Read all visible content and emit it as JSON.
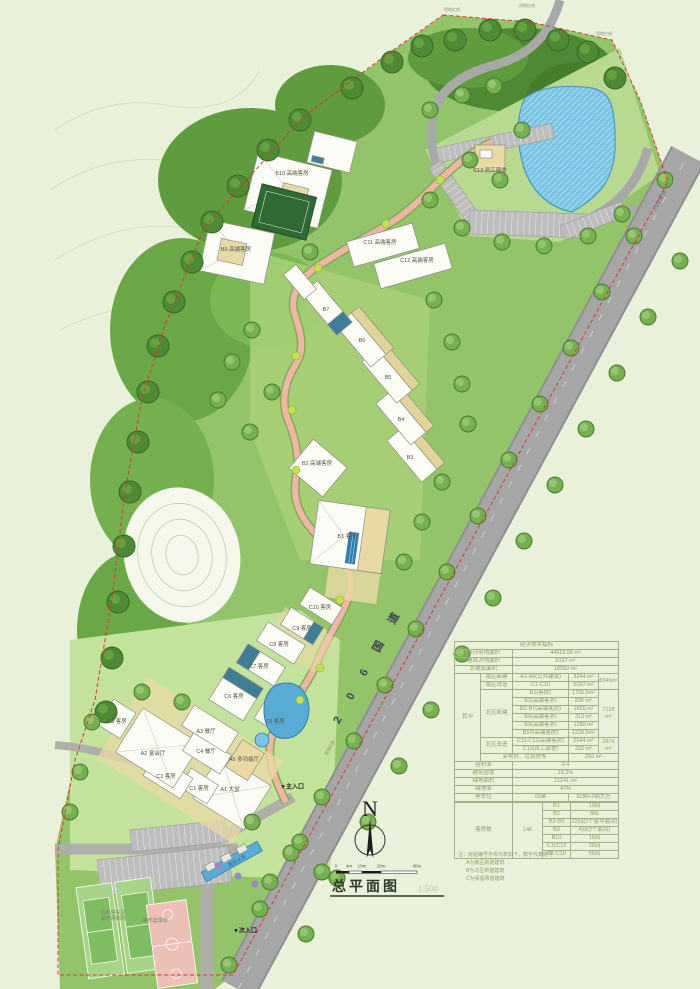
{
  "title_block": {
    "title": "总平面图",
    "scale": "1:500"
  },
  "north": {
    "label": "N"
  },
  "scalebar": {
    "ticks": [
      "0",
      "4m",
      "10m",
      "20m",
      "40m"
    ]
  },
  "road": {
    "name_spaced": "2 0 6 国 道",
    "name_small": "206国道"
  },
  "boundary": {
    "label": "用地红线"
  },
  "entrances": {
    "main": "▼主入口",
    "secondary": "▼次入口"
  },
  "water": {
    "feature_label": "景观水系"
  },
  "sports": {
    "court1_line1": "临时停车区",
    "court1_line2": "兼作网球场",
    "court2": "兼作篮球场"
  },
  "buildings": [
    {
      "label": "A1 大堂"
    },
    {
      "label": "A2 宴会厅"
    },
    {
      "label": "A3 餐厅"
    },
    {
      "label": "A6 多功能厅"
    },
    {
      "label": "C1 客房"
    },
    {
      "label": "C2 客房"
    },
    {
      "label": "C3 客房"
    },
    {
      "label": "C4 餐厅"
    },
    {
      "label": "C5 客房"
    },
    {
      "label": "C6 客房"
    },
    {
      "label": "C7 客房"
    },
    {
      "label": "C8 客房"
    },
    {
      "label": "C9 客房"
    },
    {
      "label": "C10 客房"
    },
    {
      "label": "B1 客房"
    },
    {
      "label": "B2 高端客房"
    },
    {
      "label": "B3"
    },
    {
      "label": "B4"
    },
    {
      "label": "B5"
    },
    {
      "label": "B6"
    },
    {
      "label": "B7"
    },
    {
      "label": "B9 高端客房"
    },
    {
      "label": "B10 高端客房"
    },
    {
      "label": "C11 高端客房"
    },
    {
      "label": "C12 高端客房"
    },
    {
      "label": "C13 员工宿舍"
    }
  ],
  "table": {
    "title": "经济技术指标",
    "land": {
      "label": "设计用地面积",
      "value": "44919.95 m²"
    },
    "footprint": {
      "label": "建筑占地面积",
      "value": "8197  m²"
    },
    "gross": {
      "label": "总建筑面积",
      "value": "18550  m²"
    },
    "among": "其中",
    "south_new": {
      "label": "南区新建",
      "name": "A1-A6(公共建筑)",
      "value": "3244 m²"
    },
    "south_renov": {
      "label": "南区改造",
      "name": "C1-C10",
      "value": "5097 m²"
    },
    "south_total": "8346m²",
    "north_new": {
      "label": "北区新建",
      "total": "7128 m²",
      "items": [
        {
          "name": "B1(客房)",
          "value": "1755.5m²"
        },
        {
          "name": "B2(高端客房)",
          "value": "896  m²"
        },
        {
          "name": "B3-B7(高端客房)",
          "value": "1665  m²"
        },
        {
          "name": "B8(高端客房)",
          "value": "313  m²"
        },
        {
          "name": "B9(高端客房)",
          "value": "1280  m²"
        },
        {
          "name": "B10(高端客房)",
          "value": "1228.5m²"
        }
      ]
    },
    "north_renov": {
      "label": "北区改造",
      "total": "2876 m²",
      "items": [
        {
          "name": "C11-C12(高端客房)",
          "value": "2544 m²"
        },
        {
          "name": "C13(员工宿舍)",
          "value": "332  m²"
        }
      ]
    },
    "utility": {
      "label": "变电房、垃圾房等",
      "value": "260  m²"
    },
    "far": {
      "label": "容积率",
      "value": "0.4"
    },
    "density": {
      "label": "建筑密度",
      "value": "18.2%"
    },
    "green_area": {
      "label": "绿地面积",
      "value": "21241  m²"
    },
    "green_rate": {
      "label": "绿地率",
      "value": "47%"
    },
    "parking": {
      "label": "停车位",
      "value": "93辆",
      "detail": "91辆+2辆大巴"
    },
    "rooms": {
      "label": "客房数",
      "total": "146",
      "items": [
        {
          "name": "B1",
          "value": "10间"
        },
        {
          "name": "B2",
          "value": "8间"
        },
        {
          "name": "B3-B8",
          "value": "22间(2个豪华套间)"
        },
        {
          "name": "B9",
          "value": "4间(2个套间)"
        },
        {
          "name": "B10",
          "value": "16间"
        },
        {
          "name": "C11C12",
          "value": "28间"
        },
        {
          "name": "C6-C10",
          "value": "56间"
        }
      ]
    },
    "notes": [
      "注：房屋编号字母代表如下，数字代表楼号",
      "A为南区新建建筑",
      "B为北区新建建筑",
      "C为保留改造建筑"
    ]
  }
}
